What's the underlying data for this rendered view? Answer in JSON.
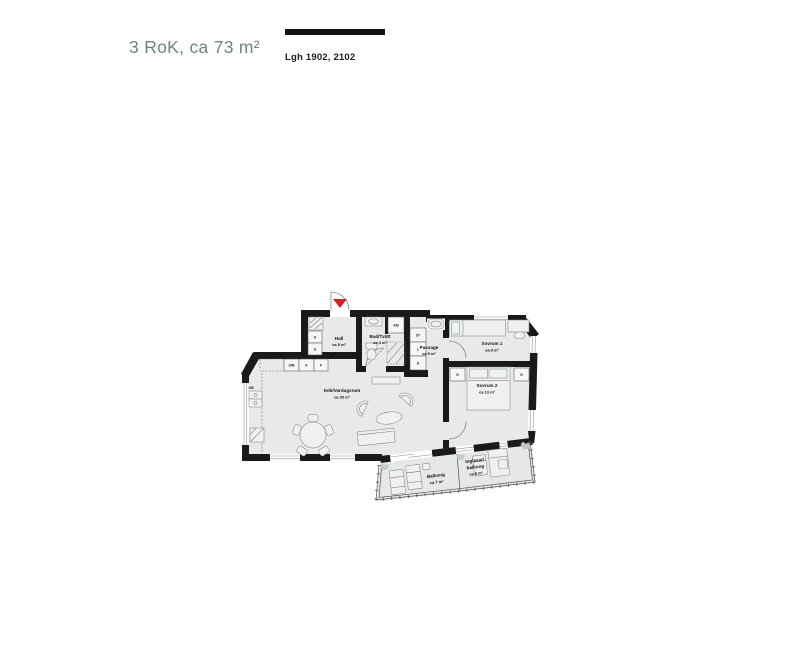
{
  "header": {
    "title": "3 RoK, ca 73 m²",
    "apartment_label": "Lgh 1902, 2102"
  },
  "floorplan": {
    "rooms": [
      {
        "id": "hall",
        "name": "Hall",
        "area": "ca 5 m²"
      },
      {
        "id": "bad_tvatt",
        "name": "Bad/Tvätt",
        "area": "ca 4 m²"
      },
      {
        "id": "passage",
        "name": "Passage",
        "area": "ca 5 m²"
      },
      {
        "id": "sovrum1",
        "name": "Sovrum 1",
        "area": "ca 8 m²"
      },
      {
        "id": "sovrum2",
        "name": "Sovrum 2",
        "area": "ca 13 m²"
      },
      {
        "id": "kok_vardagsrum",
        "name": "Kök/Vardagsrum",
        "area": "ca 35 m²"
      },
      {
        "id": "balkong",
        "name": "Balkong",
        "area": "ca 7 m²"
      },
      {
        "id": "inglasad_balkong",
        "name": "Inglasad balkong",
        "name_lines": [
          "Inglasad",
          "balkong"
        ],
        "area": "ca 8 m²"
      }
    ],
    "fixtures": {
      "hall_g1": "G",
      "hall_g2": "G",
      "um": "U/M",
      "k": "K",
      "f": "F",
      "dm": "DM",
      "km": "KM",
      "st": "ST",
      "l": "L",
      "passage_g": "G",
      "sov2_g_left": "G",
      "sov2_g_right": "G"
    },
    "colors": {
      "wall": "#1a1a1a",
      "floor": "#e8e9e9",
      "entrance_red": "#cc2a24",
      "title_teal": "#6e8485"
    }
  }
}
